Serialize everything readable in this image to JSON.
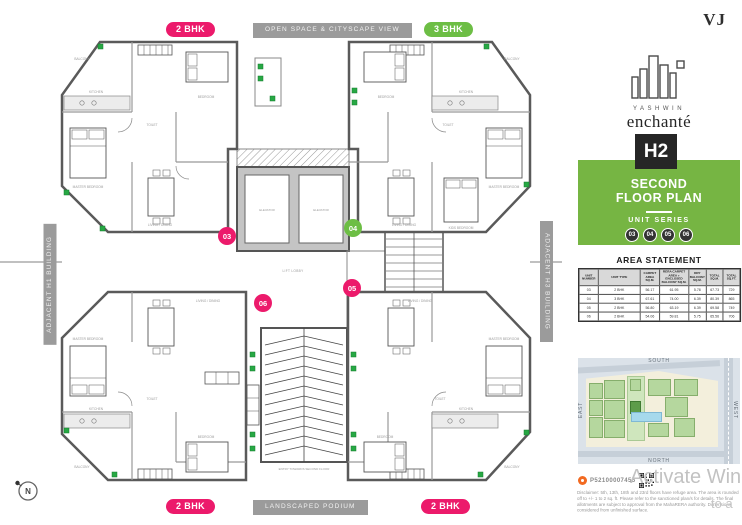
{
  "badges": {
    "top_left": "2 BHK",
    "top_center": "OPEN SPACE & CITYSCAPE VIEW",
    "top_right": "3 BHK",
    "bottom_left": "2 BHK",
    "bottom_center": "LANDSCAPED PODIUM",
    "bottom_right": "2 BHK",
    "left_vertical": "ADJACENT H1 BUILDING",
    "right_vertical": "ADJACENT H3 BUILDING"
  },
  "plan": {
    "compass": "N",
    "labels": {
      "master_bedroom": "MASTER BEDROOM",
      "bedroom": "BEDROOM",
      "kids_bedroom": "KIDS BEDROOM",
      "kitchen": "KITCHEN",
      "living_dining": "LIVING / DINING",
      "toilet": "TOILET",
      "balcony": "BALCONY",
      "elevator": "ELEVATOR",
      "lift_lobby": "LIFT LOBBY",
      "passage": "PASSAGE",
      "entry": "ENTRY TOWARDS SECOND FLOOR"
    },
    "units": [
      {
        "no": "03",
        "color": "#EC1A6B"
      },
      {
        "no": "04",
        "color": "#6DBE45"
      },
      {
        "no": "05",
        "color": "#EC1A6B"
      },
      {
        "no": "06",
        "color": "#EC1A6B"
      }
    ]
  },
  "sidebar": {
    "vj_logo": "VJ",
    "brand_top": "YASHWIN",
    "brand_name": "enchanté",
    "tower": "H2",
    "floor_line1": "SECOND",
    "floor_line2": "FLOOR PLAN",
    "unit_series_label": "UNIT SERIES",
    "unit_series": [
      "03",
      "04",
      "05",
      "06"
    ],
    "area_statement": {
      "title": "AREA STATEMENT",
      "columns": [
        "UNIT NUMBER",
        "UNIT TYPE",
        "CARPET AREA SQ.M.",
        "RERA CARPET AREA + ENCLOSED BALCONY SQ.M.",
        "DRY BALCONY SQ.M.",
        "TOTAL SQ.M.",
        "TOTAL SQ.FT."
      ],
      "rows": [
        [
          "03",
          "2 BHK",
          "56.17",
          "61.95",
          "5.78",
          "67.73",
          "729"
        ],
        [
          "04",
          "3 BHK",
          "67.61",
          "74.00",
          "6.39",
          "80.39",
          "865"
        ],
        [
          "05",
          "2 BHK",
          "56.80",
          "63.19",
          "6.39",
          "69.58",
          "749"
        ],
        [
          "06",
          "2 BHK",
          "54.06",
          "59.81",
          "5.75",
          "65.56",
          "706"
        ]
      ]
    },
    "site_map": {
      "top": "SOUTH",
      "bottom": "NORTH",
      "left": "EAST",
      "right": "WEST"
    },
    "rera_number": "P52100007455",
    "disclaimer": "Disclaimer: 5th, 13th, 18th and 23rd floors have refuge area. The area is rounded off to +/- 1 to 2 sq. ft. Please refer to the sanctioned plan/s for details. The final allotments are subject to approval from the MahaRERA authority. Dimensions considered from unfinished surface."
  },
  "watermark": {
    "line1": "Activate Wind",
    "line2": "to a"
  },
  "colors": {
    "pink": "#EC1A6B",
    "green": "#6DBE45",
    "green_panel": "#76B543",
    "gray_badge": "#9B9B9B",
    "wall": "#5A5A5A",
    "planter": "#27A844",
    "h2_bg": "#262626",
    "map_bg": "#DBE2E9",
    "map_site": "#F3EFDC",
    "map_building": "#B5D79E",
    "pool": "#A6D9EC",
    "rera_orange": "#F26A21",
    "watermark": "#C2C2C2"
  }
}
